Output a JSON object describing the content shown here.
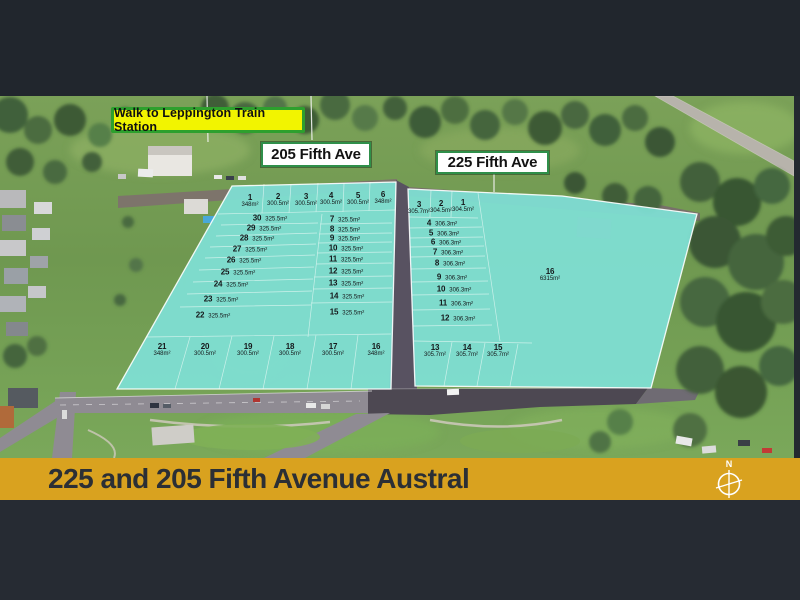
{
  "banner": {
    "title": "225 and 205 Fifth Avenue Austral",
    "bg_color": "#d9a21f",
    "compass_letter": "N"
  },
  "colors": {
    "frame": "#232930",
    "parcel_teal": "#7fe0d5",
    "train_label_bg": "#f2f400",
    "train_label_border": "#2da02d"
  },
  "overlays": {
    "train_station_label": "Walk to Leppington Train Station"
  },
  "parcels": [
    {
      "id": "205",
      "street_label": "205 Fifth Ave",
      "lots": [
        {
          "n": "1",
          "size": "348m²",
          "x": 250,
          "y": 201
        },
        {
          "n": "2",
          "size": "300.5m²",
          "x": 278,
          "y": 200
        },
        {
          "n": "3",
          "size": "300.5m²",
          "x": 306,
          "y": 200
        },
        {
          "n": "4",
          "size": "300.5m²",
          "x": 331,
          "y": 199
        },
        {
          "n": "5",
          "size": "300.5m²",
          "x": 358,
          "y": 199
        },
        {
          "n": "6",
          "size": "348m²",
          "x": 383,
          "y": 198
        },
        {
          "n": "30",
          "size": "325.5m²",
          "x": 270,
          "y": 218,
          "inline": true
        },
        {
          "n": "29",
          "size": "325.5m²",
          "x": 264,
          "y": 228,
          "inline": true
        },
        {
          "n": "28",
          "size": "325.5m²",
          "x": 257,
          "y": 238,
          "inline": true
        },
        {
          "n": "27",
          "size": "325.5m²",
          "x": 250,
          "y": 249,
          "inline": true
        },
        {
          "n": "26",
          "size": "325.5m²",
          "x": 244,
          "y": 260,
          "inline": true
        },
        {
          "n": "25",
          "size": "325.5m²",
          "x": 238,
          "y": 272,
          "inline": true
        },
        {
          "n": "24",
          "size": "325.5m²",
          "x": 231,
          "y": 284,
          "inline": true
        },
        {
          "n": "23",
          "size": "325.5m²",
          "x": 221,
          "y": 299,
          "inline": true
        },
        {
          "n": "22",
          "size": "325.5m²",
          "x": 213,
          "y": 315,
          "inline": true
        },
        {
          "n": "7",
          "size": "325.5m²",
          "x": 345,
          "y": 219,
          "inline": true
        },
        {
          "n": "8",
          "size": "325.5m²",
          "x": 345,
          "y": 229,
          "inline": true
        },
        {
          "n": "9",
          "size": "325.5m²",
          "x": 345,
          "y": 238,
          "inline": true
        },
        {
          "n": "10",
          "size": "325.5m²",
          "x": 346,
          "y": 248,
          "inline": true
        },
        {
          "n": "11",
          "size": "325.5m²",
          "x": 346,
          "y": 259,
          "inline": true
        },
        {
          "n": "12",
          "size": "325.5m²",
          "x": 346,
          "y": 271,
          "inline": true
        },
        {
          "n": "13",
          "size": "325.5m²",
          "x": 346,
          "y": 283,
          "inline": true
        },
        {
          "n": "14",
          "size": "325.5m²",
          "x": 347,
          "y": 296,
          "inline": true
        },
        {
          "n": "15",
          "size": "325.5m²",
          "x": 347,
          "y": 312,
          "inline": true
        },
        {
          "n": "21",
          "size": "348m²",
          "x": 162,
          "y": 350
        },
        {
          "n": "20",
          "size": "300.5m²",
          "x": 205,
          "y": 350
        },
        {
          "n": "19",
          "size": "300.5m²",
          "x": 248,
          "y": 350
        },
        {
          "n": "18",
          "size": "300.5m²",
          "x": 290,
          "y": 350
        },
        {
          "n": "17",
          "size": "300.5m²",
          "x": 333,
          "y": 350
        },
        {
          "n": "16",
          "size": "348m²",
          "x": 376,
          "y": 350
        }
      ]
    },
    {
      "id": "225",
      "street_label": "225 Fifth Ave",
      "lots": [
        {
          "n": "3",
          "size": "305.7m²",
          "x": 419,
          "y": 208
        },
        {
          "n": "2",
          "size": "304.5m²",
          "x": 441,
          "y": 207
        },
        {
          "n": "1",
          "size": "304.5m²",
          "x": 463,
          "y": 206
        },
        {
          "n": "4",
          "size": "306.3m²",
          "x": 442,
          "y": 223,
          "inline": true
        },
        {
          "n": "5",
          "size": "306.3m²",
          "x": 444,
          "y": 233,
          "inline": true
        },
        {
          "n": "6",
          "size": "306.3m²",
          "x": 446,
          "y": 242,
          "inline": true
        },
        {
          "n": "7",
          "size": "306.3m²",
          "x": 448,
          "y": 252,
          "inline": true
        },
        {
          "n": "8",
          "size": "306.3m²",
          "x": 450,
          "y": 263,
          "inline": true
        },
        {
          "n": "9",
          "size": "306.3m²",
          "x": 452,
          "y": 277,
          "inline": true
        },
        {
          "n": "10",
          "size": "306.3m²",
          "x": 454,
          "y": 289,
          "inline": true
        },
        {
          "n": "11",
          "size": "306.3m²",
          "x": 456,
          "y": 303,
          "inline": true
        },
        {
          "n": "12",
          "size": "306.3m²",
          "x": 458,
          "y": 318,
          "inline": true
        },
        {
          "n": "16",
          "size": "6315m²",
          "x": 550,
          "y": 275
        },
        {
          "n": "13",
          "size": "305.7m²",
          "x": 435,
          "y": 351
        },
        {
          "n": "14",
          "size": "305.7m²",
          "x": 467,
          "y": 351
        },
        {
          "n": "15",
          "size": "305.7m²",
          "x": 498,
          "y": 351
        }
      ]
    }
  ]
}
